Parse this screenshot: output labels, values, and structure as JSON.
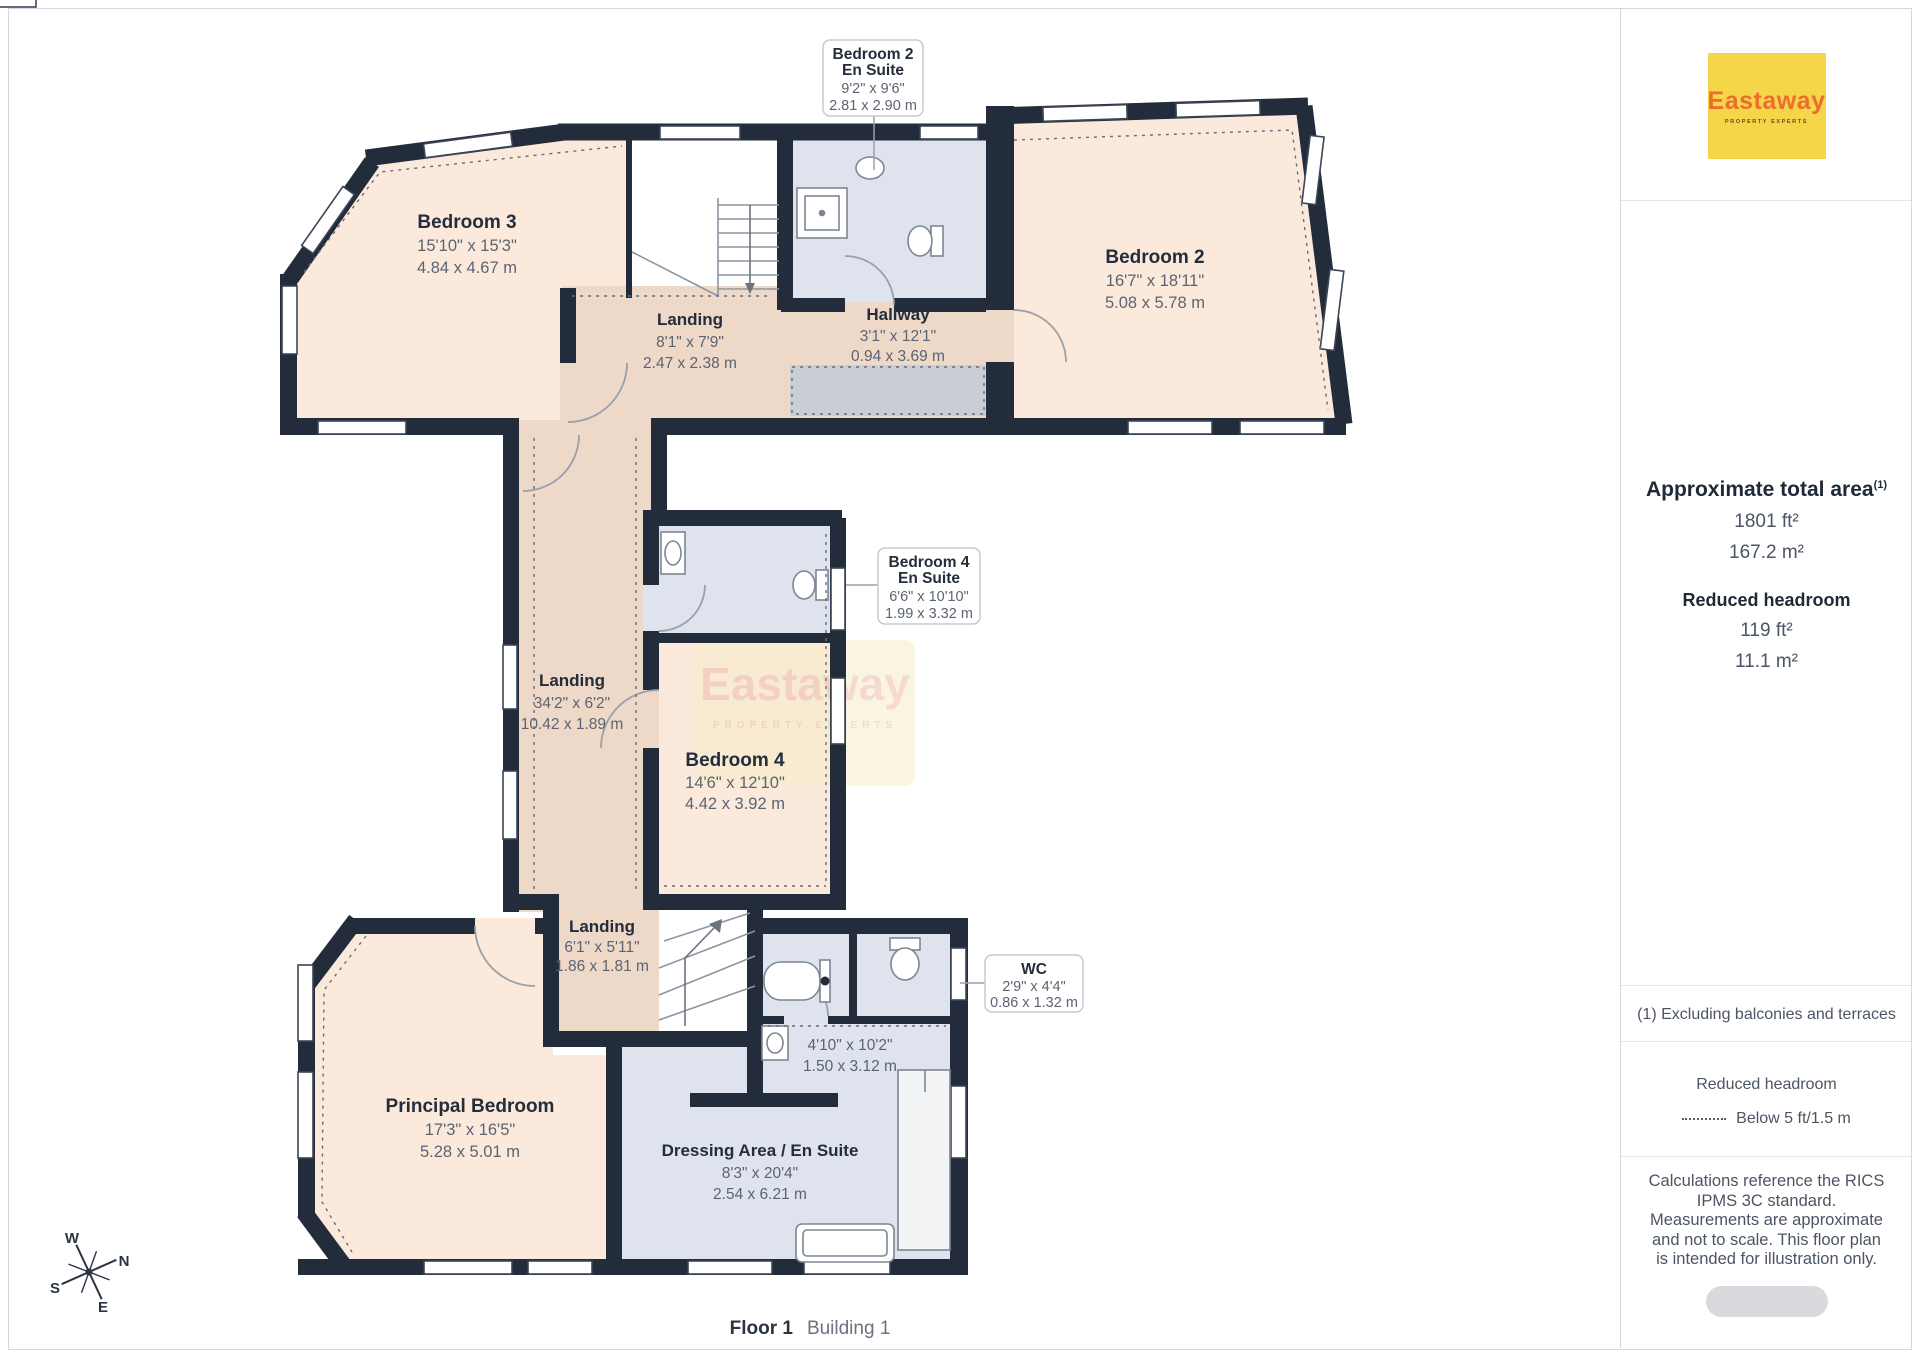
{
  "plan": {
    "rooms": [
      {
        "name": "Bedroom 3",
        "dims_ft": "15'10\" x 15'3\"",
        "dims_m": "4.84 x 4.67 m"
      },
      {
        "name": "Landing",
        "dims_ft": "8'1\" x 7'9\"",
        "dims_m": "2.47 x 2.38 m"
      },
      {
        "name": "Hallway",
        "dims_ft": "3'1\" x 12'1\"",
        "dims_m": "0.94 x 3.69 m"
      },
      {
        "name": "Bedroom 2",
        "dims_ft": "16'7\" x 18'11\"",
        "dims_m": "5.08 x 5.78 m"
      },
      {
        "name": "Landing",
        "dims_ft": "34'2\" x 6'2\"",
        "dims_m": "10.42 x 1.89 m"
      },
      {
        "name": "Bedroom 4",
        "dims_ft": "14'6\" x 12'10\"",
        "dims_m": "4.42 x 3.92 m"
      },
      {
        "name": "Landing",
        "dims_ft": "6'1\" x 5'11\"",
        "dims_m": "1.86 x 1.81 m"
      },
      {
        "name": "Principal Bedroom",
        "dims_ft": "17'3\" x 16'5\"",
        "dims_m": "5.28 x 5.01 m"
      },
      {
        "name": "Dressing Area /  En Suite",
        "dims_ft": "8'3\" x 20'4\"",
        "dims_m": "2.54 x 6.21 m"
      },
      {
        "name": "",
        "dims_ft": "4'10\" x 10'2\"",
        "dims_m": "1.50 x 3.12 m"
      }
    ],
    "callouts": [
      {
        "name": "Bedroom 2",
        "name2": "En Suite",
        "dims_ft": "9'2\" x 9'6\"",
        "dims_m": "2.81 x 2.90 m"
      },
      {
        "name": "Bedroom 4",
        "name2": "En Suite",
        "dims_ft": "6'6\" x 10'10\"",
        "dims_m": "1.99 x 3.32 m"
      },
      {
        "name": "WC",
        "dims_ft": "2'9\" x 4'4\"",
        "dims_m": "0.86 x 1.32 m"
      }
    ],
    "compass": {
      "n": "N",
      "s": "S",
      "e": "E",
      "w": "W"
    },
    "watermark": {
      "brand": "Eastaway",
      "tagline": "PROPERTY EXPERTS"
    }
  },
  "footer": {
    "floor": "Floor 1",
    "building": "Building 1"
  },
  "sidebar": {
    "logo": {
      "brand": "Eastaway",
      "tagline": "PROPERTY EXPERTS"
    },
    "area": {
      "title": "Approximate total area",
      "superscript": "(1)",
      "value_ft": "1801 ft²",
      "value_m": "167.2 m²",
      "reduced_title": "Reduced headroom",
      "reduced_ft": "119 ft²",
      "reduced_m": "11.1 m²"
    },
    "note_exclusion": "(1) Excluding balconies and terraces",
    "legend": {
      "title": "Reduced headroom",
      "label": "Below 5 ft/1.5 m"
    },
    "disclaimer": "Calculations reference the RICS IPMS 3C standard. Measurements are approximate and not to scale. This floor plan is intended for illustration only."
  },
  "colors": {
    "wall": "#232c3b",
    "room_cream": "#fbe9dc",
    "room_tan": "#eed8c8",
    "room_bath": "#dfe3ee",
    "reduced_gray": "#c9cdd4",
    "brand_yellow": "#f6d649",
    "brand_orange": "#ee6c30"
  }
}
